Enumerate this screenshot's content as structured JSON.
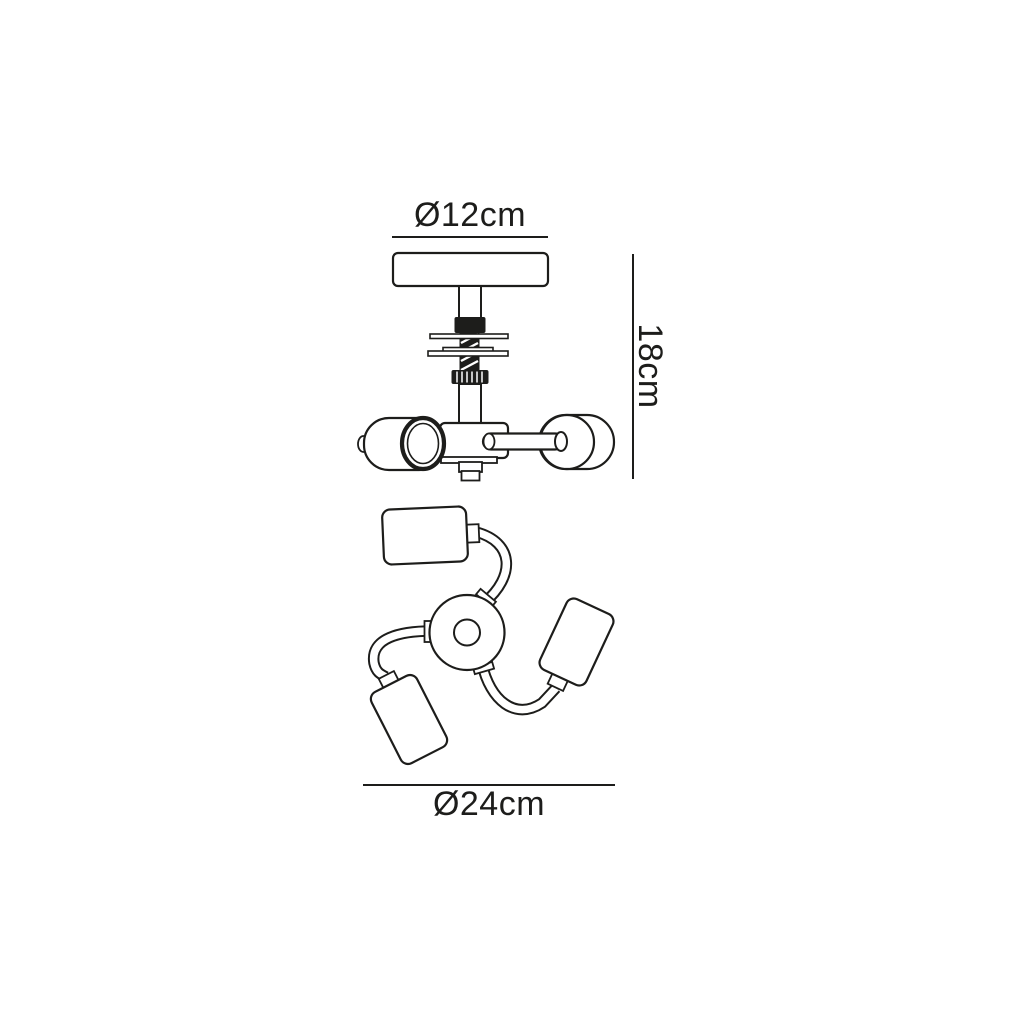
{
  "page": {
    "background_color": "#ffffff",
    "line_color": "#1d1d1b",
    "text_color": "#1d1d1b"
  },
  "diagram": {
    "kind": "ceiling-spotlight-dimension-drawing",
    "dimensions": {
      "canopy_diameter": {
        "label": "Ø12cm"
      },
      "drop_height": {
        "label": "18cm"
      },
      "fixture_diameter": {
        "label": "Ø24cm"
      }
    }
  }
}
